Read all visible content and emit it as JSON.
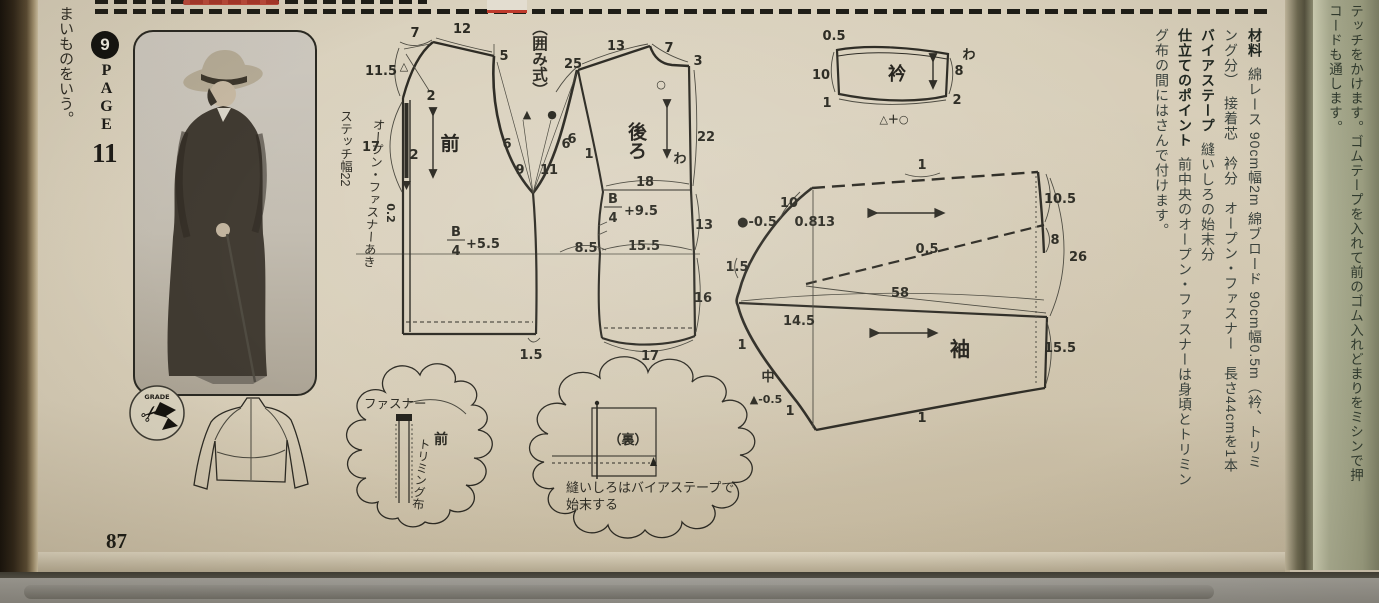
{
  "page": {
    "side_note": "まいものをいう。",
    "badge": "9",
    "page_word": "PAGE",
    "page_num": "11",
    "folio": "87",
    "grade": "GRADE"
  },
  "method_label": "（囲み式）",
  "front": {
    "title": "前",
    "stitch_note": "ステッチ幅22",
    "zipper_note": "オープン・ファスナーあき",
    "f_num": "B",
    "f_den": "4",
    "f_suf": "+5.5",
    "t7": "7",
    "t12": "12",
    "r5": "5",
    "l115": "11.5",
    "tri": "△",
    "d2a": "2",
    "l17": "17",
    "d2b": "2",
    "z02": "0.2",
    "a6l": "6",
    "a6r": "6",
    "b9": "9",
    "b11": "11",
    "mtri": "▲",
    "mdot": "●",
    "w85": "8.5",
    "h15": "1.5"
  },
  "back": {
    "title": "後ろ",
    "f_num": "B",
    "f_den": "4",
    "f_suf": "+9.5",
    "t13": "13",
    "t7": "7",
    "l25": "25",
    "r3": "3",
    "circ": "○",
    "r22": "22",
    "fold": "わ",
    "w18": "18",
    "r13": "13",
    "w155": "15.5",
    "r16": "16",
    "b17": "17",
    "a6": "6",
    "a1": "1"
  },
  "collar": {
    "title": "衿",
    "t05": "0.5",
    "l10": "10",
    "bl1": "1",
    "r8": "8",
    "br2": "2",
    "fold": "わ",
    "marks": "△＋○"
  },
  "sleeve": {
    "title": "袖",
    "t1": "1",
    "c10": "10",
    "dot05": "●-0.5",
    "n08": "0.8",
    "n13": "13",
    "r105": "10.5",
    "r8": "8",
    "r26": "26",
    "m05": "0.5",
    "w58": "58",
    "v145": "14.5",
    "l15": "1.5",
    "l1": "1",
    "center": "中",
    "tri05": "▲-0.5",
    "d1": "1",
    "r155": "15.5",
    "b1": "1"
  },
  "detail1": {
    "zipper": "ファスナー",
    "front": "前",
    "trim": "トリミング布"
  },
  "detail2": {
    "back": "（裏）",
    "cap1": "縫いしろはバイアステープで",
    "cap2": "始末する"
  },
  "materials": {
    "c1h": "材料",
    "c1b": "綿レース 90cm幅2m 綿ブロード 90cm幅0.5m（衿、トリミ",
    "c2": "ング分）　接着芯　衿分　オープン・ファスナー　長さ44cmを1本",
    "c3h": "バイアステープ",
    "c3b": "縫いしろの始末分",
    "c4h": "仕立てのポイント",
    "c4b": "前中央のオープン・ファスナーは身頃とトリミン",
    "c5": "グ布の間にはさんで付けます。"
  },
  "nextpage": {
    "c1": "テッチをかけます。ゴムテープを入れて前のゴム入れどまりをミシンで押",
    "c2": "コードも通します。"
  }
}
